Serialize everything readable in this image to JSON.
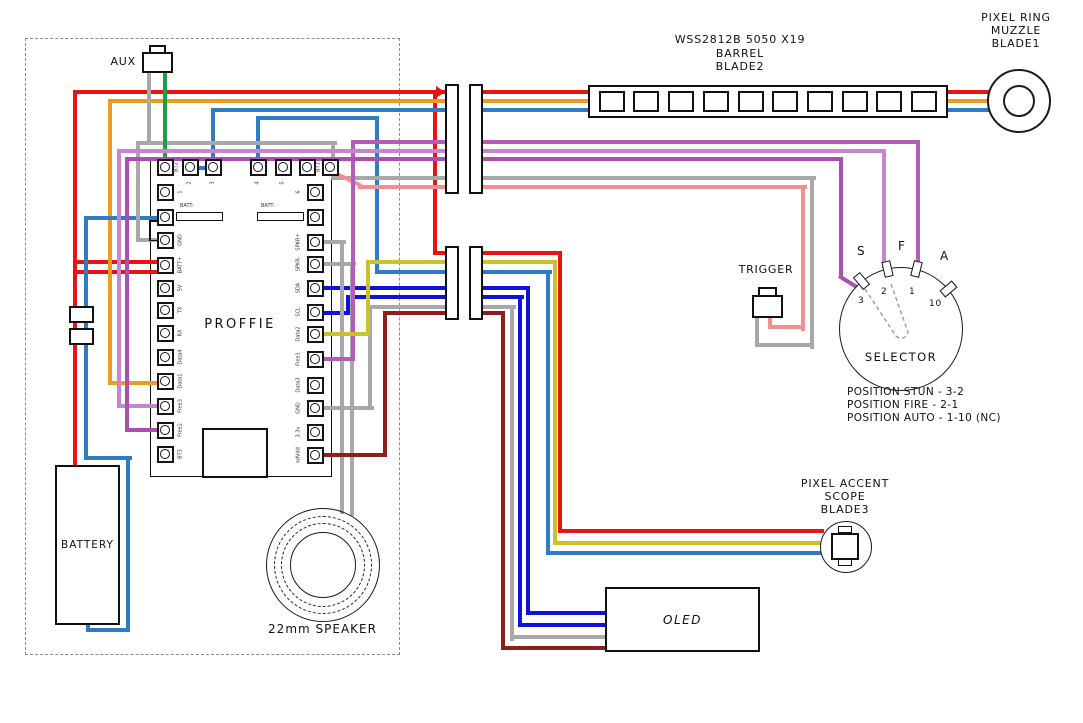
{
  "diagram": {
    "labels": {
      "aux": "AUX",
      "board": "PROFFIE",
      "battery": "BATTERY",
      "speaker": "22mm SPEAKER",
      "trigger": "TRIGGER",
      "oled": "OLED",
      "selector": "SELECTOR",
      "batt_tab": "BATT-"
    },
    "barrel": {
      "title_lines": [
        "WSS2812B 5050 X19",
        "BARREL",
        "BLADE2"
      ],
      "pixel_count": 10
    },
    "ring": {
      "title_lines": [
        "PIXEL RING",
        "MUZZLE",
        "BLADE1"
      ]
    },
    "scope": {
      "title_lines": [
        "PIXEL ACCENT",
        "SCOPE",
        "BLADE3"
      ]
    },
    "selector": {
      "letters": [
        {
          "t": "S",
          "x": 857,
          "y": 244
        },
        {
          "t": "F",
          "x": 898,
          "y": 239
        },
        {
          "t": "A",
          "x": 940,
          "y": 249
        }
      ],
      "tabs": [
        {
          "n": "3",
          "x": 861,
          "y": 281,
          "r": -40,
          "nx": 858,
          "ny": 296
        },
        {
          "n": "2",
          "x": 887,
          "y": 269,
          "r": -13,
          "nx": 881,
          "ny": 287
        },
        {
          "n": "1",
          "x": 916,
          "y": 269,
          "r": 14,
          "nx": 909,
          "ny": 287
        },
        {
          "n": "10",
          "x": 948,
          "y": 289,
          "r": 50,
          "nx": 929,
          "ny": 299
        }
      ],
      "positions": [
        "POSITION STUN - 3-2",
        "POSITION FIRE - 2-1",
        "POSITION AUTO - 1-10 (NC)"
      ]
    },
    "pads": {
      "top": [
        {
          "l": "BT2",
          "x": 165
        },
        {
          "l": "2",
          "x": 190
        },
        {
          "l": "3",
          "x": 213
        },
        {
          "l": "4",
          "x": 258
        },
        {
          "l": "5",
          "x": 283
        },
        {
          "l": "",
          "x": 307
        },
        {
          "l": "BT1",
          "x": 330
        }
      ],
      "left": [
        {
          "l": "1",
          "y": 192
        },
        {
          "l": "BATT-",
          "y": 217
        },
        {
          "l": "GND",
          "y": 240
        },
        {
          "l": "BATT+",
          "y": 265
        },
        {
          "l": "5V",
          "y": 288
        },
        {
          "l": "TX",
          "y": 310
        },
        {
          "l": "RX",
          "y": 333
        },
        {
          "l": "Data4",
          "y": 357
        },
        {
          "l": "Data1",
          "y": 381
        },
        {
          "l": "Free3",
          "y": 406
        },
        {
          "l": "Free2",
          "y": 430
        },
        {
          "l": "BT3",
          "y": 454
        }
      ],
      "right": [
        {
          "l": "6",
          "y": 192
        },
        {
          "l": "BATT-",
          "y": 217
        },
        {
          "l": "SPKR+",
          "y": 242
        },
        {
          "l": "SPKR-",
          "y": 264
        },
        {
          "l": "SDA",
          "y": 288
        },
        {
          "l": "SCL",
          "y": 312
        },
        {
          "l": "Data2",
          "y": 334
        },
        {
          "l": "Free1",
          "y": 359
        },
        {
          "l": "Data3",
          "y": 385
        },
        {
          "l": "GND",
          "y": 408
        },
        {
          "l": "3.3v",
          "y": 432
        },
        {
          "l": "sdVdd",
          "y": 455
        }
      ]
    },
    "wires": [
      {
        "name": "battery-positive-wire",
        "color": "#e81414",
        "rects": [
          [
            73,
            90,
            919,
            4
          ],
          [
            73,
            90,
            4,
            377
          ],
          [
            73,
            260,
            95,
            4
          ],
          [
            73,
            270,
            95,
            4
          ],
          [
            433,
            90,
            4,
            165
          ],
          [
            433,
            251,
            129,
            4
          ],
          [
            558,
            251,
            4,
            282
          ],
          [
            558,
            529,
            266,
            4
          ]
        ]
      },
      {
        "name": "barrel-data1-wire",
        "color": "#f09b1c",
        "rects": [
          [
            108,
            99,
            884,
            4
          ],
          [
            108,
            99,
            4,
            286
          ],
          [
            108,
            381,
            60,
            4
          ]
        ]
      },
      {
        "name": "barrel-blade2-data-wire",
        "color": "#2e7cc3",
        "rects": [
          [
            188,
            166,
            27,
            4
          ],
          [
            211,
            108,
            4,
            56
          ],
          [
            211,
            108,
            781,
            4
          ]
        ]
      },
      {
        "name": "scope-blade3-data-wire",
        "color": "#2e7cc3",
        "rects": [
          [
            256,
            116,
            4,
            48
          ],
          [
            256,
            116,
            123,
            4
          ],
          [
            375,
            116,
            4,
            158
          ],
          [
            375,
            270,
            177,
            4
          ],
          [
            546,
            270,
            4,
            285
          ],
          [
            546,
            551,
            278,
            4
          ]
        ]
      },
      {
        "name": "battery-negative-wire",
        "color": "#2e7cc3",
        "rects": [
          [
            84,
            216,
            84,
            4
          ],
          [
            84,
            216,
            4,
            244
          ],
          [
            84,
            456,
            48,
            4
          ],
          [
            126,
            456,
            4,
            176
          ],
          [
            86,
            628,
            44,
            4
          ],
          [
            86,
            622,
            4,
            8
          ]
        ]
      },
      {
        "name": "oled-sda-wire",
        "color": "#1111d8",
        "rects": [
          [
            312,
            286,
            218,
            4
          ],
          [
            526,
            286,
            4,
            329
          ],
          [
            526,
            611,
            83,
            4
          ]
        ]
      },
      {
        "name": "oled-scl-wire",
        "color": "#1111d8",
        "rects": [
          [
            312,
            311,
            40,
            4
          ],
          [
            346,
            295,
            4,
            20
          ],
          [
            346,
            295,
            178,
            4
          ],
          [
            518,
            295,
            4,
            332
          ],
          [
            518,
            623,
            91,
            4
          ]
        ]
      },
      {
        "name": "aux-ground-wire",
        "color": "#a8a8a8",
        "rects": [
          [
            147,
            71,
            4,
            74
          ],
          [
            136,
            141,
            201,
            4
          ],
          [
            136,
            141,
            4,
            101
          ],
          [
            136,
            238,
            34,
            4
          ]
        ]
      },
      {
        "name": "trigger-ground-wire",
        "color": "#a8a8a8",
        "rects": [
          [
            331,
            141,
            4,
            39
          ],
          [
            331,
            176,
            485,
            4
          ],
          [
            810,
            176,
            4,
            173
          ],
          [
            755,
            343,
            59,
            4
          ],
          [
            755,
            313,
            4,
            34
          ]
        ]
      },
      {
        "name": "speaker-positive-wire",
        "color": "#a8a8a8",
        "rects": [
          [
            312,
            240,
            34,
            4
          ],
          [
            340,
            240,
            4,
            274
          ]
        ]
      },
      {
        "name": "speaker-negative-wire",
        "color": "#a8a8a8",
        "rects": [
          [
            312,
            262,
            44,
            4
          ],
          [
            350,
            262,
            4,
            254
          ]
        ]
      },
      {
        "name": "oled-ground-wire",
        "color": "#a8a8a8",
        "rects": [
          [
            312,
            406,
            62,
            4
          ],
          [
            368,
            305,
            4,
            105
          ],
          [
            368,
            305,
            148,
            4
          ],
          [
            510,
            305,
            4,
            336
          ],
          [
            510,
            635,
            99,
            4
          ]
        ]
      },
      {
        "name": "trigger-bt1-wire",
        "color": "#f29090",
        "rects": [
          [
            358,
            185,
            449,
            4
          ],
          [
            801,
            185,
            4,
            146
          ],
          [
            768,
            325,
            37,
            4
          ],
          [
            768,
            313,
            4,
            16
          ]
        ],
        "diags": [
          [
            331,
            169,
            34,
            26
          ]
        ]
      },
      {
        "name": "aux-bt2-wire",
        "color": "#18a245",
        "rects": [
          [
            163,
            71,
            4,
            96
          ]
        ]
      },
      {
        "name": "selector-free1-wire",
        "color": "#b45cb8",
        "rects": [
          [
            312,
            357,
            43,
            4
          ],
          [
            351,
            140,
            4,
            221
          ],
          [
            351,
            140,
            569,
            4
          ],
          [
            916,
            140,
            4,
            132
          ]
        ]
      },
      {
        "name": "selector-free3-wire",
        "color": "#c685d0",
        "rects": [
          [
            117,
            404,
            53,
            4
          ],
          [
            117,
            149,
            4,
            259
          ],
          [
            117,
            149,
            769,
            4
          ],
          [
            882,
            149,
            4,
            119
          ]
        ]
      },
      {
        "name": "selector-free2-wire",
        "color": "#ac4fb2",
        "rects": [
          [
            125,
            428,
            45,
            4
          ],
          [
            125,
            157,
            4,
            275
          ],
          [
            125,
            157,
            718,
            4
          ],
          [
            839,
            157,
            4,
            119
          ]
        ],
        "diags": [
          [
            839,
            274,
            24,
            32
          ]
        ]
      },
      {
        "name": "scope-data2-wire",
        "color": "#ccc12b",
        "rects": [
          [
            312,
            332,
            58,
            4
          ],
          [
            366,
            260,
            4,
            76
          ],
          [
            366,
            260,
            191,
            4
          ],
          [
            553,
            260,
            4,
            285
          ],
          [
            553,
            541,
            269,
            4
          ]
        ]
      },
      {
        "name": "oled-power-wire",
        "color": "#8e1f1f",
        "rects": [
          [
            312,
            453,
            75,
            4
          ],
          [
            383,
            311,
            4,
            146
          ],
          [
            383,
            311,
            122,
            4
          ],
          [
            501,
            311,
            4,
            339
          ],
          [
            501,
            646,
            108,
            4
          ]
        ]
      }
    ]
  }
}
